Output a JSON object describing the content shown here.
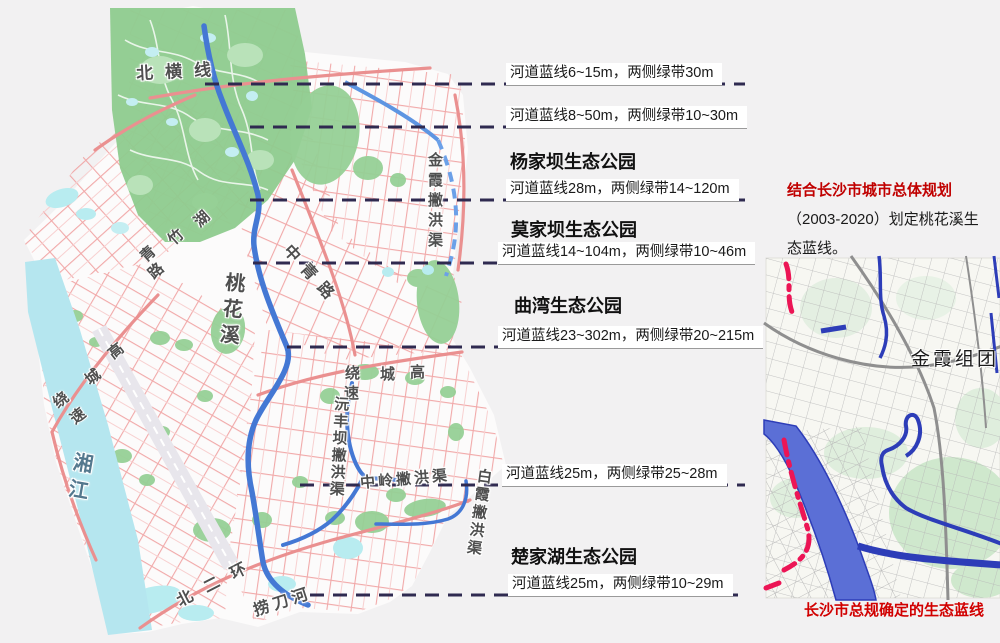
{
  "figure": {
    "type": "urban-planning-map",
    "subject": "桃花溪生态蓝线规划"
  },
  "sections": [
    {
      "title": "",
      "note": "河道蓝线6~15m，两侧绿带30m"
    },
    {
      "title": "",
      "note": "河道蓝线8~50m，两侧绿带10~30m"
    },
    {
      "title": "杨家坝生态公园",
      "note": "河道蓝线28m，两侧绿带14~120m"
    },
    {
      "title": "莫家坝生态公园",
      "note": "河道蓝线14~104m，两侧绿带10~46m"
    },
    {
      "title": "曲湾生态公园",
      "note": "河道蓝线23~302m，两侧绿带20~215m"
    },
    {
      "title": "",
      "note": "河道蓝线25m，两侧绿带25~28m"
    },
    {
      "title": "楚家湖生态公园",
      "note": "河道蓝线25m，两侧绿带10~29m"
    }
  ],
  "side_note": {
    "line1": "结合长沙市城市总体规划",
    "line2": "（2003-2020）划定桃花溪生",
    "line3": "态蓝线。"
  },
  "inset": {
    "area_label": "金霞组团",
    "caption": "长沙市总规确定的生态蓝线"
  },
  "map_labels": {
    "north_line": "北横线",
    "qingzhuhu_chars": [
      "湖",
      "竹",
      "青",
      "路"
    ],
    "taohuaxi": "桃花溪",
    "zhongqing_road": "中青路",
    "jinxia_channel": "金霞撇洪渠",
    "ring_east_chars": [
      "绕",
      "城",
      "高",
      "速"
    ],
    "yuanfengba_channel": "沅丰坝撇洪渠",
    "zhongling_channel": "中岭撇洪渠",
    "baixia_channel": "白霞撇洪渠",
    "ring_west_chars": [
      "高",
      "城",
      "绕",
      "速"
    ],
    "xiangjiang": "湘江",
    "beierhuan": "北二环",
    "laodaohe": "捞刀河"
  },
  "colors": {
    "leader_dash": "#2f2a50",
    "river_blue": "#4478d4",
    "channel_dash_blue": "#6ba0e8",
    "road_pink": "#f0a0a0",
    "forest_green": "#8ecb8e",
    "water_cyan": "#b5e6ef",
    "eco_blueline_red": "#ec1555",
    "note_red": "#c00000"
  }
}
